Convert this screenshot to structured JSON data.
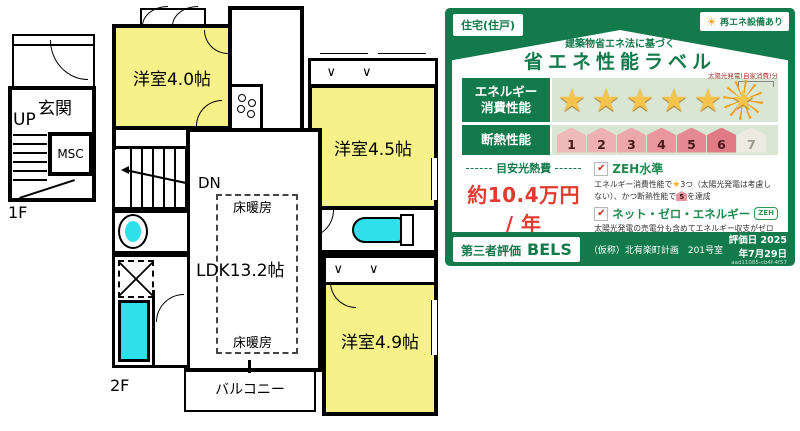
{
  "icons": {
    "star": "★",
    "check": "✔",
    "sun": "☀",
    "bifold": "∨∨"
  },
  "colors": {
    "label_green": "#127a4b",
    "row_background": "#d9e6d4",
    "room_yellow": "#f6f189",
    "fixture_cyan": "#2fdfe9",
    "price_red": "#e23a2e",
    "star_gold": "#f4c44d"
  },
  "floorplan": {
    "floor1": {
      "label": "1F",
      "entrance": "玄関",
      "up": "UP",
      "msc": "MSC"
    },
    "floor2": {
      "label": "2F",
      "room40": "洋室4.0帖",
      "room45": "洋室4.5帖",
      "room49": "洋室4.9帖",
      "ldk": "LDK13.2帖",
      "floor_heating_top": "床暖房",
      "floor_heating_bottom": "床暖房",
      "dn": "DN",
      "balcony": "バルコニー"
    }
  },
  "label": {
    "building_type": "住宅(住戸)",
    "renewable_badge": "再エネ設備あり",
    "subtitle": "建築物省エネ法に基づく",
    "title": "省エネ性能ラベル",
    "energy_row_label_1": "エネルギー",
    "energy_row_label_2": "消費性能",
    "energy_stars": 5,
    "solar_note": "太陽光発電(自家消費)分",
    "insulation_row_label": "断熱性能",
    "insulation_levels": [
      {
        "value": "1",
        "color": "#efb9b9",
        "achieved": true
      },
      {
        "value": "2",
        "color": "#eeb0b2",
        "achieved": true
      },
      {
        "value": "3",
        "color": "#eca7aa",
        "achieved": true
      },
      {
        "value": "4",
        "color": "#e9979d",
        "achieved": true
      },
      {
        "value": "5",
        "color": "#e58a92",
        "achieved": true
      },
      {
        "value": "6",
        "color": "#e07b85",
        "achieved": true
      },
      {
        "value": "7",
        "color": "#eceae1",
        "achieved": false
      }
    ],
    "cost_heading": "目安光熱費",
    "cost_value": "約10.4万円 / 年",
    "cost_note": "目安光熱費は、住宅の省エネ性能と全国一律の燃料等の単価を用いて算出したものです。実際の光熱費は、使用条件や設備、契約会社・方法などにより異なります。",
    "zeh_level_label": "ZEH水準",
    "zeh_note_a": "エネルギー消費性能で",
    "zeh_note_b": "3つ（太陽光発電は考慮しない）、かつ断熱性能で",
    "zeh_house_level": "5",
    "zeh_note_c": "を達成",
    "net_zero_label": "ネット・ゼロ・エネルギー",
    "zeh_badge": "ZEH",
    "net_zero_note": "太陽光発電の売電分も含めてエネルギー収支がゼロ以下を達成",
    "evaluation_label": "第三者評価",
    "bels": "BELS",
    "project_name": "（仮称）北有楽町計画　201号室",
    "evaluation_date": "評価日 2025年7月29日",
    "evaluation_code": "aad11085-cb4f-4f57"
  }
}
